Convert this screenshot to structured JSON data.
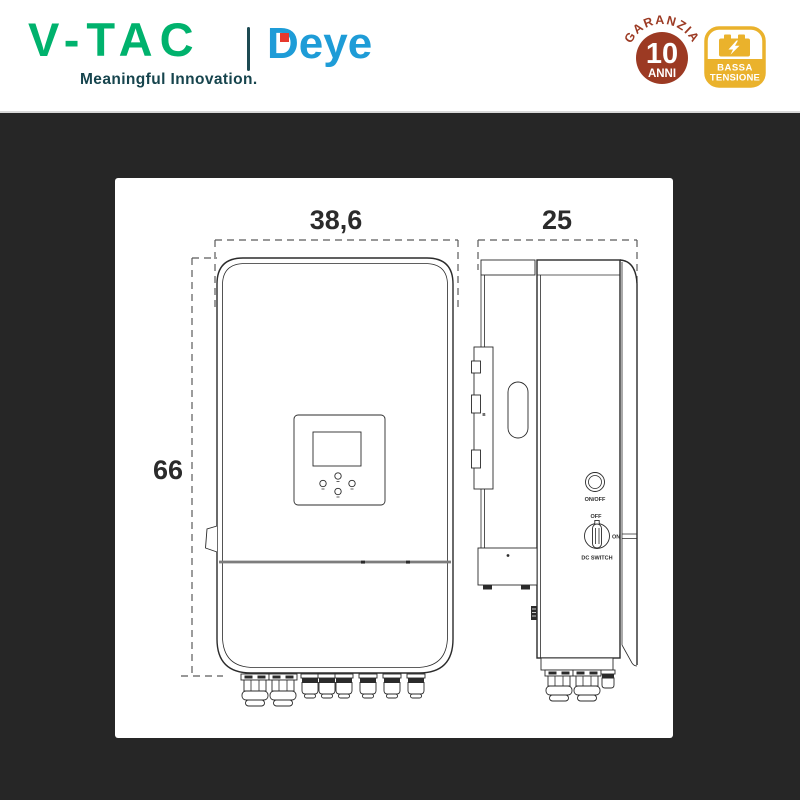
{
  "header": {
    "brand": "V-TAC",
    "tagline": "Meaningful Innovation.",
    "partner_brand": "Deye"
  },
  "badges": {
    "warranty": {
      "arc_text": "GARANZIA",
      "years": "10",
      "unit": "ANNI"
    },
    "low_voltage": {
      "line1": "BASSA",
      "line2": "TENSIONE",
      "icon": "battery-bolt-icon"
    }
  },
  "diagram": {
    "width_cm": "38,6",
    "depth_cm": "25",
    "height_cm": "66",
    "labels": {
      "power_button": "ON/OFF",
      "switch_off": "OFF",
      "switch_on": "ON",
      "switch_name": "DC SWITCH",
      "bracket_mark": "B"
    }
  },
  "colors": {
    "background_dark": "#262626",
    "brand_green": "#00b26d",
    "brand_teal": "#16444d",
    "deye_blue": "#1e9cd7",
    "deye_red": "#e6382d",
    "warranty_red": "#9c3a23",
    "voltage_yellow": "#eab22c",
    "line_color": "#2b2b2b"
  }
}
